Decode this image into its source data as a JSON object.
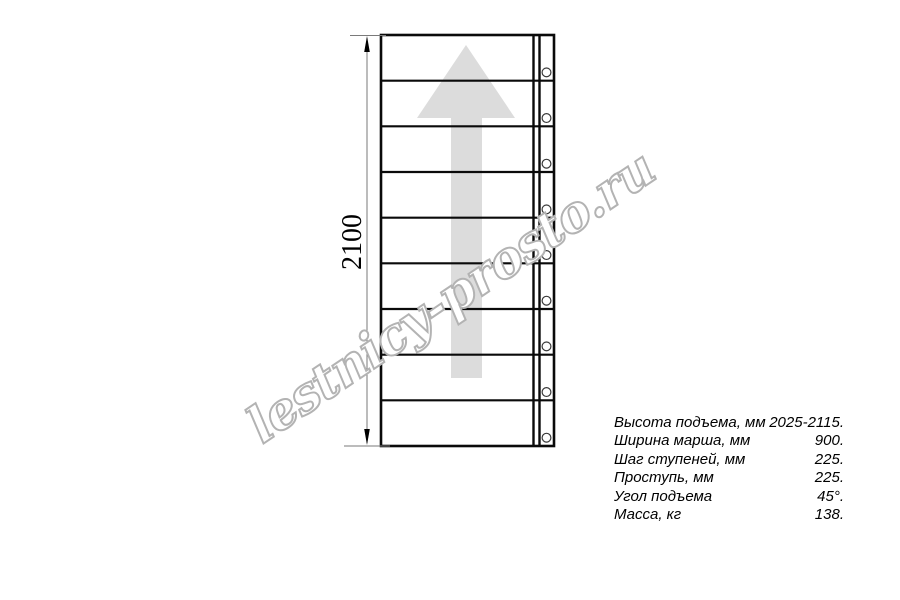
{
  "drawing": {
    "dimension_label": "2100",
    "watermark": "lestnicy-prosto.ru",
    "steps_count": 9,
    "arrow_color": "#dcdcdc",
    "line_color": "#0a0a0a",
    "dim_line_color": "#7a7a7a",
    "watermark_stroke": "#b3b3b3",
    "watermark_fill": "#ffffff"
  },
  "specs": {
    "rows": [
      {
        "label": "Высота подъема, мм",
        "value": "2025-2115."
      },
      {
        "label": "Ширина марша, мм",
        "value": "900."
      },
      {
        "label": "Шаг ступеней, мм",
        "value": "225."
      },
      {
        "label": "Проступь, мм",
        "value": "225."
      },
      {
        "label": "Угол подъема",
        "value": "45°."
      },
      {
        "label": "Масса, кг",
        "value": "138."
      }
    ]
  }
}
